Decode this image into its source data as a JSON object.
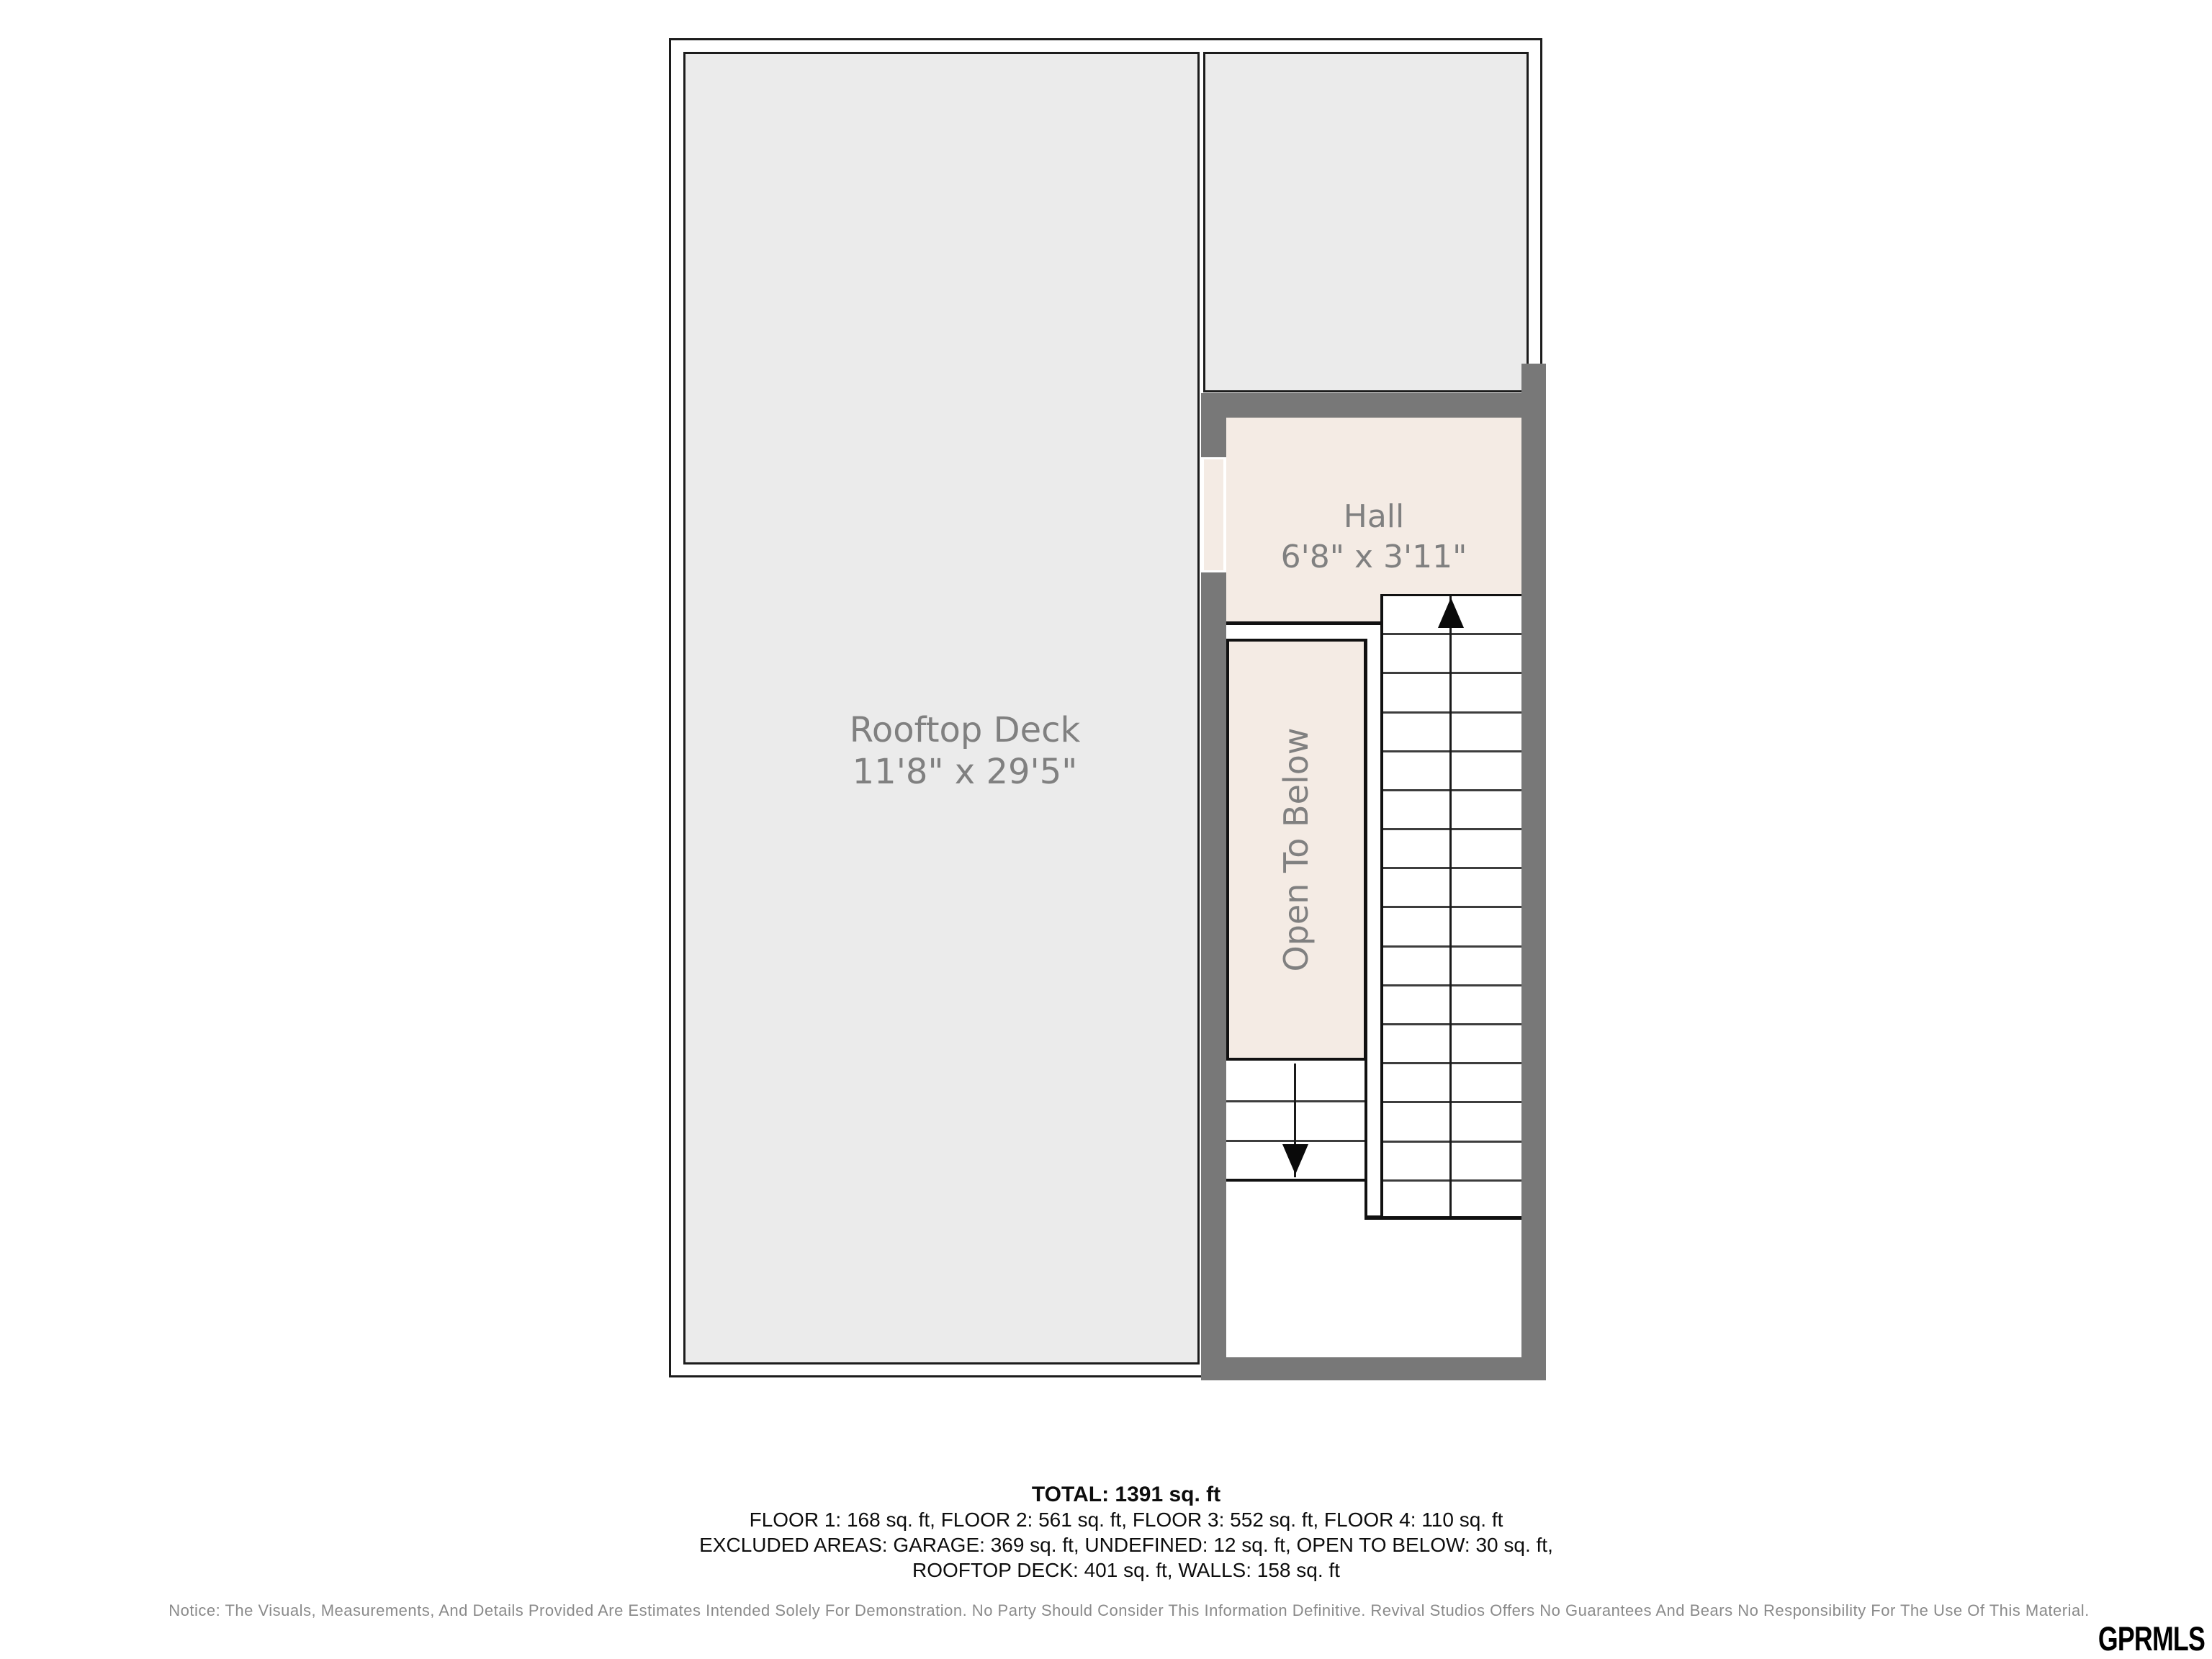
{
  "plan": {
    "deck": {
      "name": "Rooftop Deck",
      "dims": "11'8\" x 29'5\""
    },
    "hall": {
      "name": "Hall",
      "dims": "6'8\" x 3'11\""
    },
    "open_to_below": {
      "label": "Open To Below"
    }
  },
  "summary": {
    "total": "TOTAL: 1391 sq. ft",
    "floors": "FLOOR 1: 168 sq. ft, FLOOR 2: 561 sq. ft, FLOOR 3: 552 sq. ft, FLOOR 4: 110 sq. ft",
    "excluded_1": "EXCLUDED AREAS: GARAGE: 369 sq. ft, UNDEFINED: 12 sq. ft, OPEN TO BELOW: 30 sq. ft,",
    "excluded_2": "ROOFTOP DECK: 401 sq. ft, WALLS: 158 sq. ft"
  },
  "notice": "Notice: The Visuals, Measurements, And Details Provided Are Estimates Intended Solely For Demonstration. No Party Should Consider This Information Definitive. Revival Studios Offers No Guarantees And Bears No Responsibility For The Use Of This Material.",
  "logo": "GPRMLS",
  "colors": {
    "wall": "#787878",
    "deck_fill": "#ebebeb",
    "room_fill": "#f4ebe4",
    "label_gray": "#808080"
  }
}
